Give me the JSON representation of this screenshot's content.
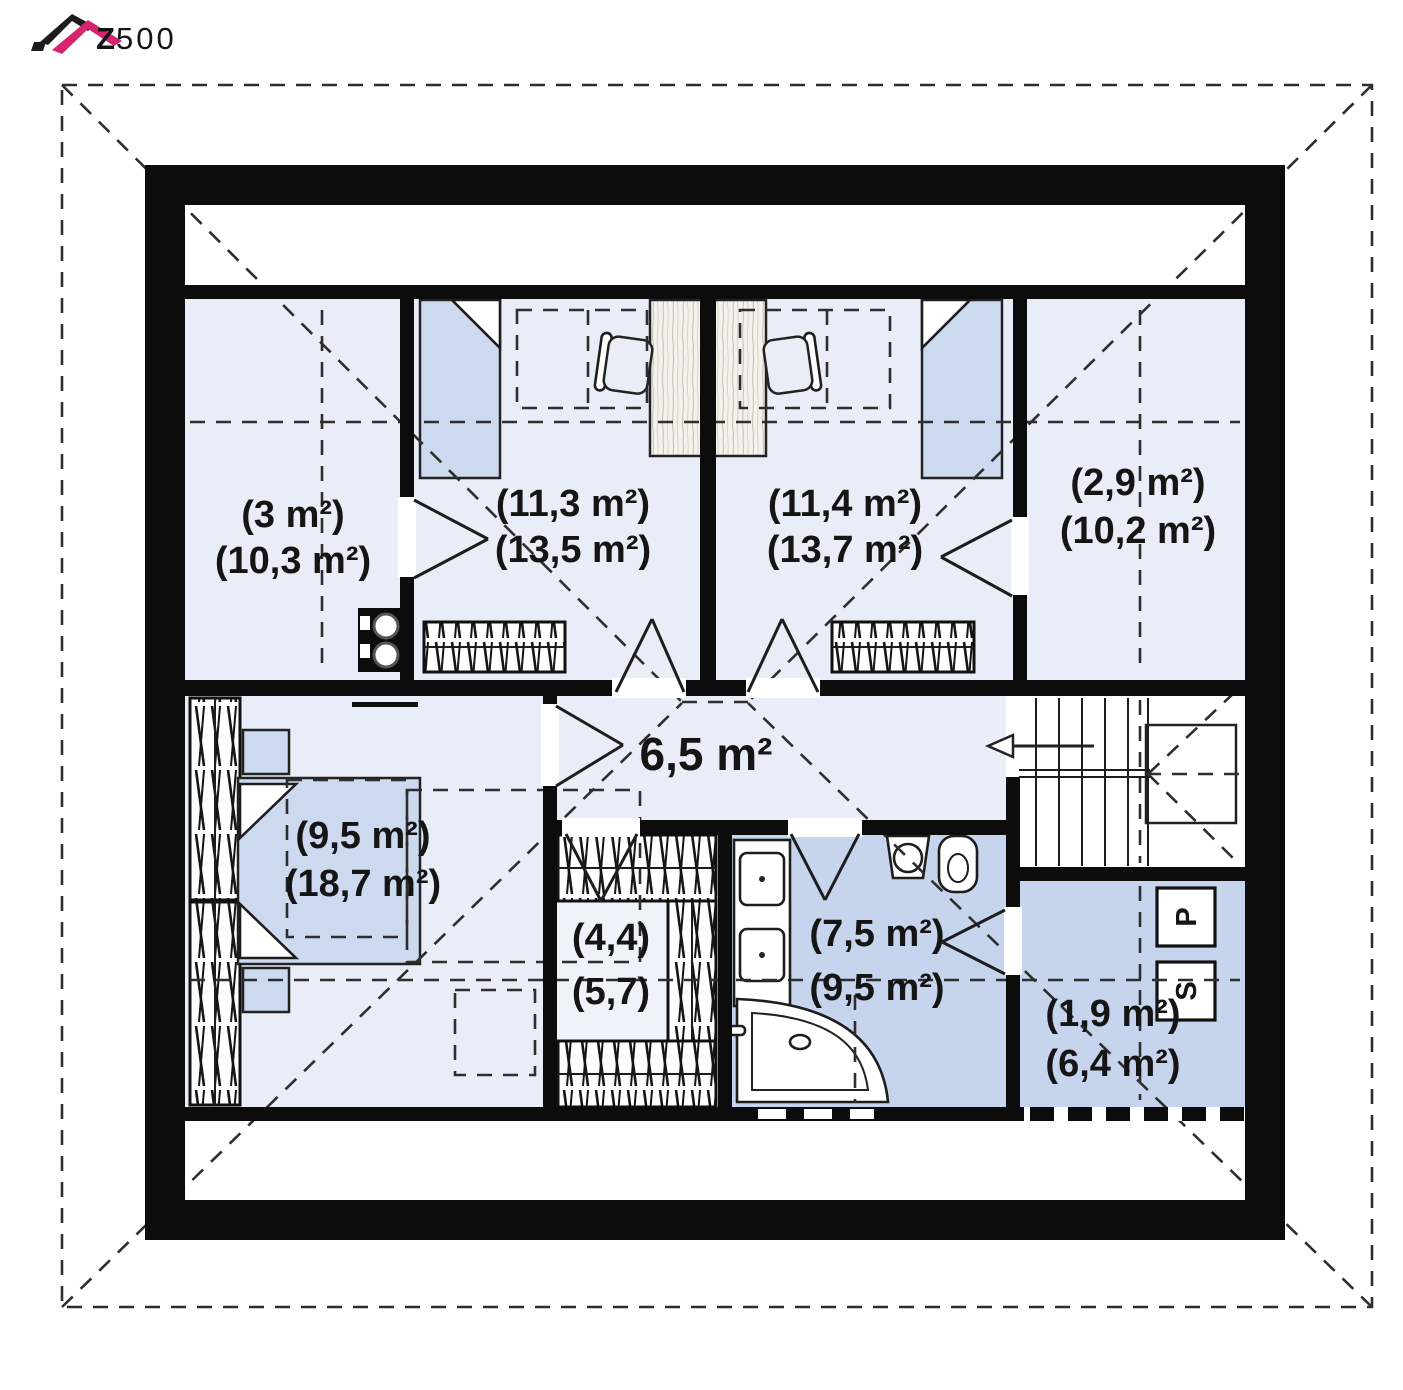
{
  "brand": {
    "wordmark_z": "Z",
    "wordmark_digits": "500"
  },
  "plan": {
    "rooms": [
      {
        "name": "storage-top-left",
        "area_usable": "(3 m²)",
        "area_floor": "(10,3 m²)"
      },
      {
        "name": "room-top-left",
        "area_usable": "(11,3 m²)",
        "area_floor": "(13,5 m²)"
      },
      {
        "name": "room-top-right",
        "area_usable": "(11,4 m²)",
        "area_floor": "(13,7 m²)"
      },
      {
        "name": "storage-top-right",
        "area_usable": "(2,9 m²)",
        "area_floor": "(10,2 m²)"
      },
      {
        "name": "hall",
        "area_usable": "6,5 m²",
        "area_floor": ""
      },
      {
        "name": "master-bedroom",
        "area_usable": "(9,5 m²)",
        "area_floor": "(18,7 m²)"
      },
      {
        "name": "wardrobe-room",
        "area_usable": "(4,4)",
        "area_floor": "(5,7)"
      },
      {
        "name": "bathroom",
        "area_usable": "(7,5 m²)",
        "area_floor": "(9,5 m²)"
      },
      {
        "name": "utility-room",
        "area_usable": "(1,9 m²)",
        "area_floor": "(6,4 m²)"
      }
    ],
    "appliances": {
      "washer_label": "P",
      "dryer_label": "S"
    }
  },
  "colors": {
    "brand_magenta": "#d6246e",
    "wall_black": "#0c0c0c",
    "room_light_fill": "#e9edf7",
    "wet_room_fill": "#c6d5ed",
    "furniture_blue": "#ccd9ef"
  }
}
